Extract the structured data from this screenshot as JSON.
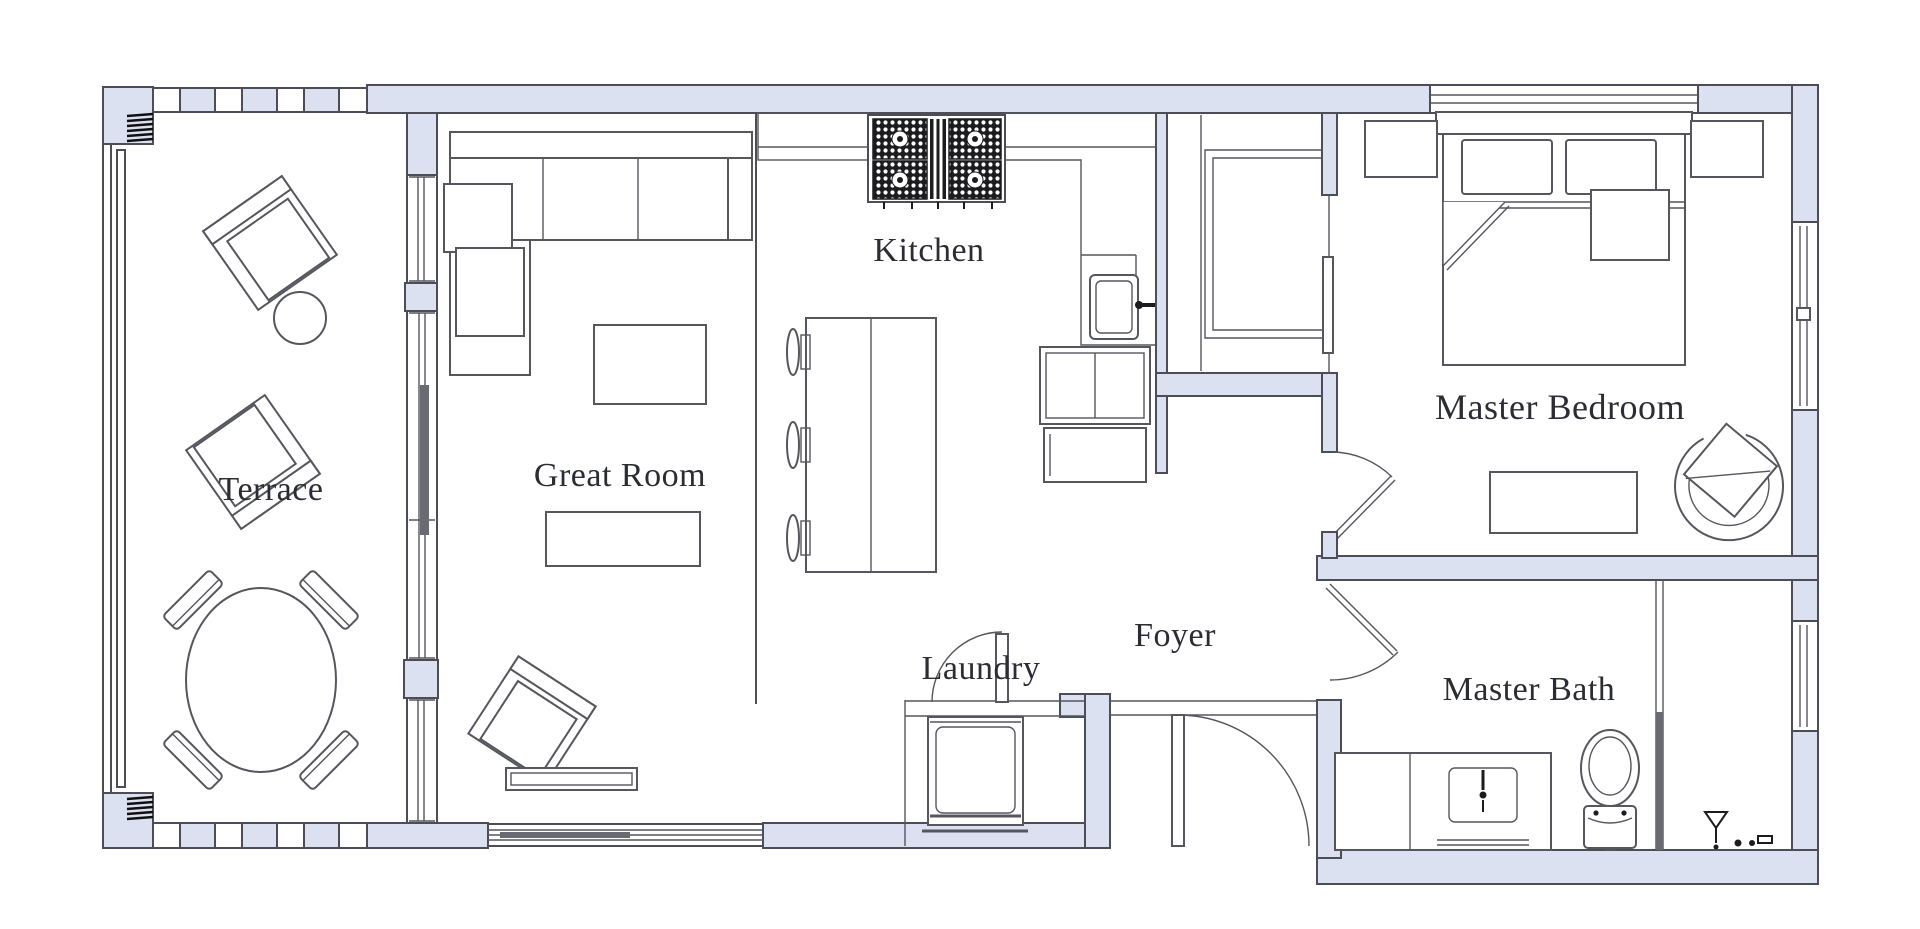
{
  "page": {
    "background": "#ffffff",
    "type": "architectural floor plan"
  },
  "palette": {
    "wall_fill": "#dce1f1",
    "wall_line": "#4c4d56",
    "furniture_line": "#55565e",
    "label_color": "#2c2d34",
    "appliance_dark": "#1c1c1e",
    "door_slab_dark": "#6a6b72"
  },
  "rooms": {
    "terrace": {
      "label": "Terrace"
    },
    "great_room": {
      "label": "Great Room"
    },
    "kitchen": {
      "label": "Kitchen"
    },
    "foyer": {
      "label": "Foyer"
    },
    "laundry": {
      "label": "Laundry"
    },
    "master_bedroom": {
      "label": "Master Bedroom"
    },
    "master_bath": {
      "label": "Master Bath"
    }
  }
}
